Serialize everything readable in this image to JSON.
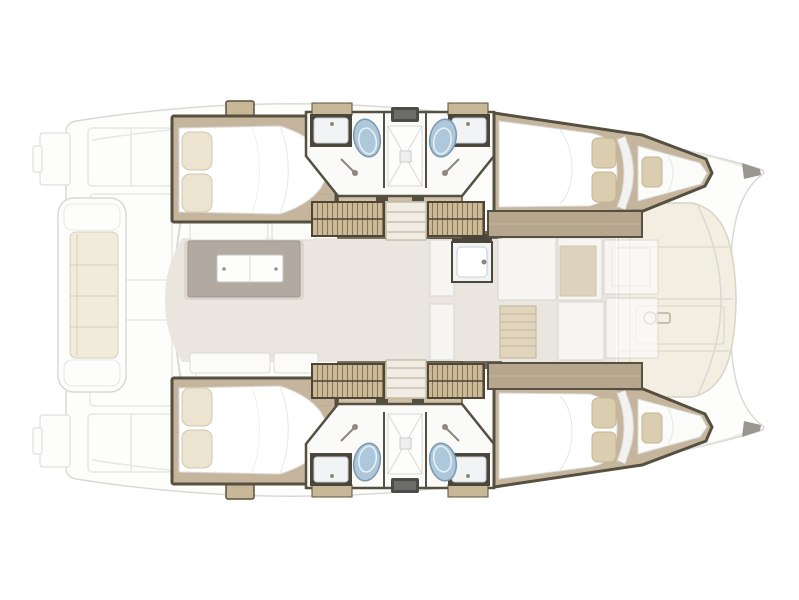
{
  "meta": {
    "title": "Catamaran interior layout — top view floor plan",
    "view": "deck plan, bow pointing right, two hulls with four cabins",
    "visible_text": []
  },
  "palette": {
    "bg": "#ffffff",
    "deck": "#fdfdfc",
    "deck_line": "#d9d9d7",
    "deck_line_soft": "#e7e7e5",
    "cushion_cream": "#f1ebdb",
    "cushion_cream_line": "#d8cfb9",
    "lounge": "#f3eee2",
    "lounge_line": "#d9d3c3",
    "wood": "#c6b59d",
    "wood_line": "#b7a68e",
    "wood_light": "#cfc0a7",
    "trim_dark": "#55503f",
    "trim_darker": "#4e4537",
    "bed_white": "#ffffff",
    "soft_line": "#dadad8",
    "pillow": "#ece4d1",
    "pillow_line": "#d1c7ac",
    "pillow_tan": "#dbceb0",
    "pillow_tan_line": "#c3b592",
    "bath_floor": "#fafaf9",
    "shower_line": "#d9d9d6",
    "hatch": "#4b4b47",
    "hatch_inner": "#6c6c68",
    "toilet": "#adc8db",
    "toilet_line": "#7d98ac",
    "toilet_inner": "#e8f1f7",
    "sink_frame": "#4a463c",
    "basin": "#f1f3f4",
    "basin_line": "#c7ccd0",
    "counter_tan": "#c9b897",
    "slat_base": "#cdbb97",
    "slat_line": "#6e6049",
    "stair": "#f0ece3",
    "stair_line": "#b2aa93",
    "salon_floor": "#eae6df",
    "sofa": "#fbfbf9",
    "table_top": "#b2a9a1",
    "table_line": "#9f968e",
    "table_leaf": "#fdfdfc",
    "leaf_line": "#c8c7c4",
    "window_dark": "#6e695d",
    "ghost_line": "#cbcbc9",
    "ghost_tan": "#d6c7ab",
    "ladder": "#dcccab",
    "ladder_line": "#a5946f",
    "metal": "#98978f",
    "icon_line": "#b7b1a0",
    "fitting_gray": "#8d887c"
  },
  "areas": [
    {
      "id": "aft-platform",
      "name": "aft deck with swim steps and bench"
    },
    {
      "id": "salon",
      "name": "central salon with dining table and sofas"
    },
    {
      "id": "galley",
      "name": "forward galley (ghosted under coachroof)"
    },
    {
      "id": "foredeck-lounge",
      "name": "forward cockpit sun lounge with windlass"
    },
    {
      "id": "starboard-hull",
      "name": "upper hull: aft double cabin, twin washrooms with central shower, forward double cabin with bow berth"
    },
    {
      "id": "port-hull",
      "name": "lower hull: mirrored layout of upper hull"
    }
  ],
  "icons": [
    {
      "id": "toilet-icon",
      "meaning": "marine toilet bowl"
    },
    {
      "id": "washbasin-icon",
      "meaning": "vanity sink with faucet"
    },
    {
      "id": "shower-icon",
      "meaning": "shower tray with drain"
    },
    {
      "id": "shower-head-icon",
      "meaning": "hand shower on wall"
    },
    {
      "id": "windlass-icon",
      "meaning": "anchor windlass on foredeck"
    },
    {
      "id": "door-swing-icon",
      "meaning": "dashed door swing arc"
    }
  ]
}
